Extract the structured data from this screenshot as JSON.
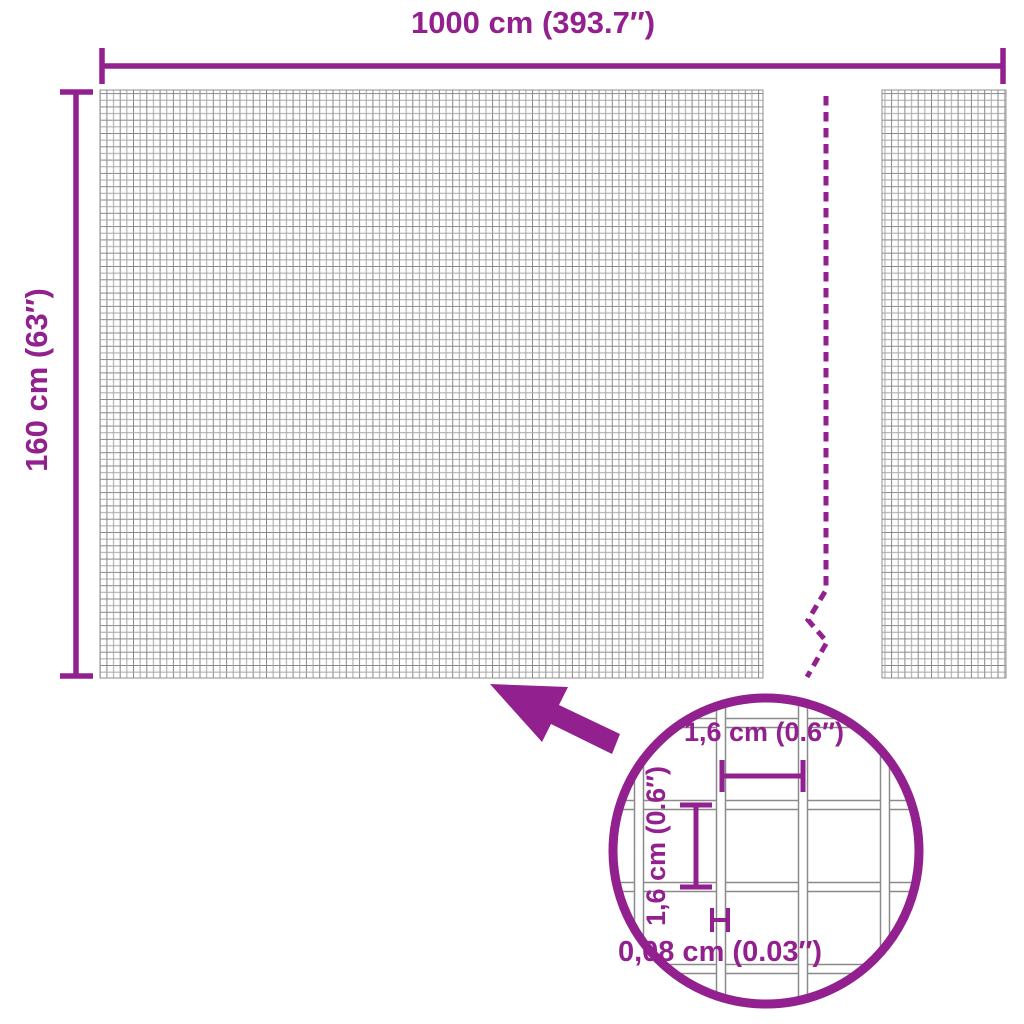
{
  "diagram": {
    "kind": "product-dimension-diagram",
    "subject": "wire mesh fence roll"
  },
  "colors": {
    "accent": "#92208e",
    "mesh_line_dark": "#878787",
    "mesh_line_light": "#a6a6a6",
    "background": "#ffffff"
  },
  "dimensions": {
    "width": {
      "label": "1000 cm (393.7″)"
    },
    "height": {
      "label": "160 cm (63″)"
    }
  },
  "detail": {
    "cell_width": {
      "label": "1,6 cm (0.6″)"
    },
    "cell_height": {
      "label": "1,6 cm (0.6″)"
    },
    "wire_thickness": {
      "label": "0,08 cm (0.03″)"
    }
  }
}
